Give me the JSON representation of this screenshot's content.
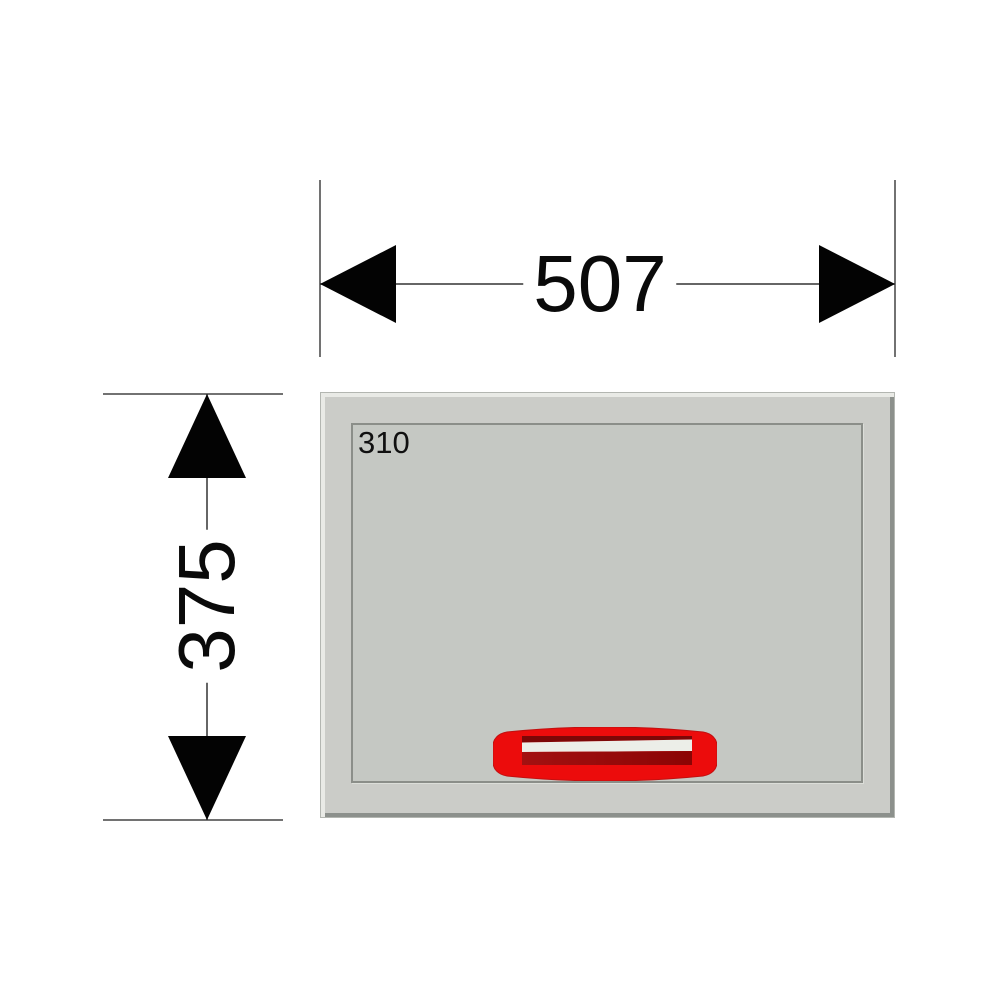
{
  "drawing": {
    "type": "dimensioned panel front view",
    "width_dimension": {
      "value": "507"
    },
    "height_dimension": {
      "value": "375"
    },
    "panel_label": "310",
    "colors": {
      "panel_fill": "#cbccc8",
      "panel_highlight": "#e9eae6",
      "panel_shadow": "#8c908c",
      "inner_frame_line": "#8b8e89",
      "handle_red": "#ec0c0c",
      "handle_dark_red": "#8b0404",
      "handle_slot_light": "#eceee8",
      "dimension_line": "#333333",
      "arrow_fill": "#000000",
      "text": "#0a0a0a"
    }
  }
}
